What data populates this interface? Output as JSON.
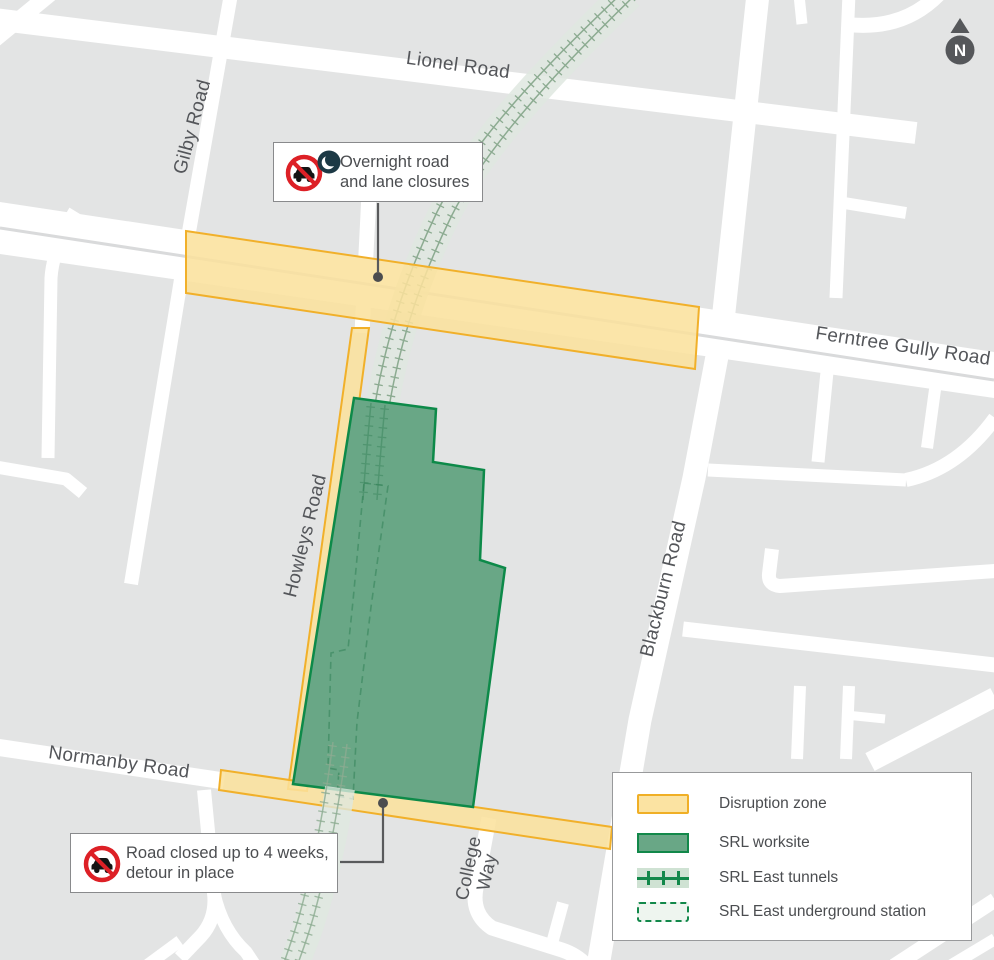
{
  "map": {
    "road_labels": {
      "lionel": "Lionel Road",
      "gilby": "Gilby Road",
      "ferntree": "Ferntree Gully Road",
      "howleys": "Howleys Road",
      "blackburn": "Blackburn Road",
      "normanby": "Normanby Road",
      "college_line1": "College",
      "college_line2": "Way"
    },
    "north_label": "N"
  },
  "callouts": {
    "overnight": {
      "line1": "Overnight road",
      "line2": "and lane closures",
      "icons": [
        "no-cars-icon",
        "night-icon"
      ]
    },
    "road_closed": {
      "line1": "Road closed up to 4 weeks,",
      "line2": "detour in place",
      "icons": [
        "no-cars-icon"
      ]
    }
  },
  "legend": {
    "items": [
      {
        "key": "disruption-zone",
        "label": "Disruption zone"
      },
      {
        "key": "srl-worksite",
        "label": "SRL worksite"
      },
      {
        "key": "srl-east-tunnels",
        "label": "SRL East tunnels"
      },
      {
        "key": "srl-east-underground-station",
        "label": "SRL East underground station"
      }
    ]
  },
  "colors": {
    "background": "#e3e4e4",
    "road": "#ffffff",
    "disruption_fill": "#fbe3a2",
    "disruption_border": "#f0af26",
    "worksite_fill": "#69a786",
    "worksite_border": "#0d8a49",
    "tunnel_line": "#8cab91",
    "tunnel_halo": "#dfe8e0",
    "station_dash": "#2c7d52",
    "label_text": "#54565a",
    "callout_text": "#4b4d50",
    "prohibition_red": "#dd2026",
    "night_navy": "#1c3945",
    "north_gray": "#55575a"
  }
}
